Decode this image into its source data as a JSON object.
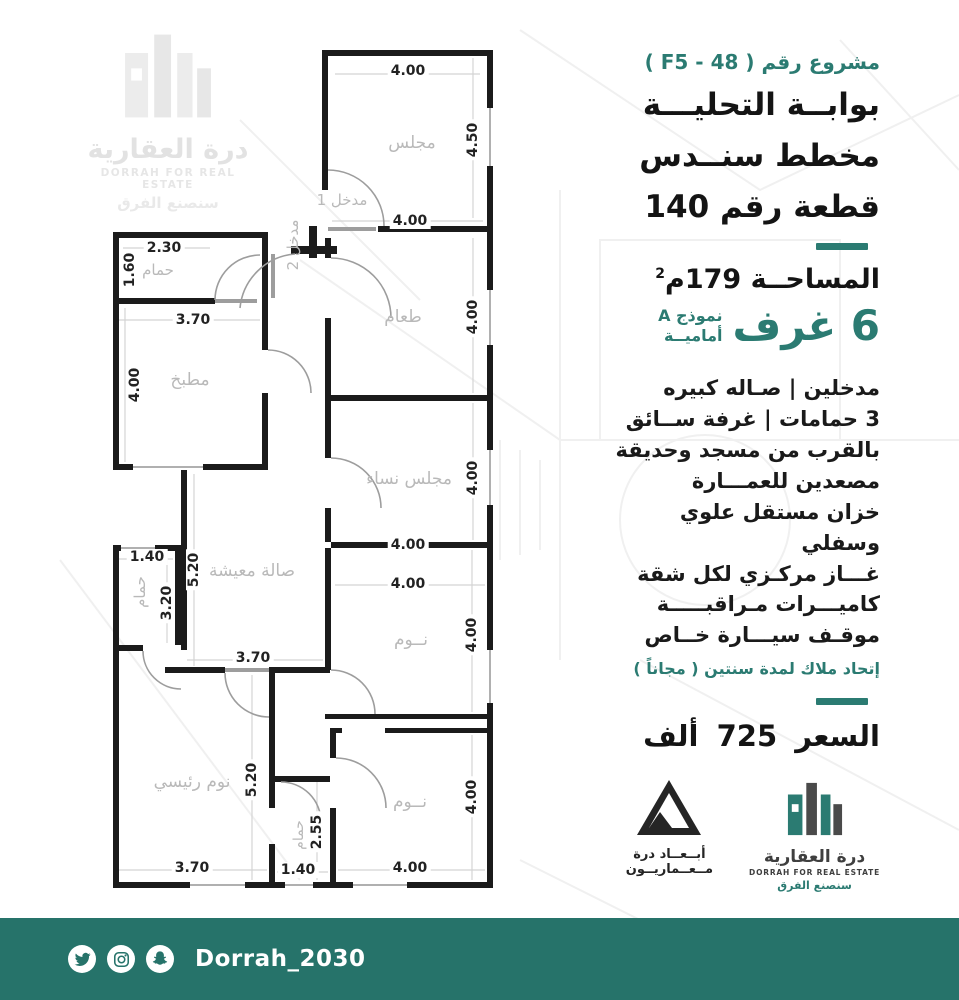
{
  "colors": {
    "accent": "#2b7b72",
    "footer": "#26736a"
  },
  "watermark": {
    "name_ar": "درة العقارية",
    "name_en": "DORRAH FOR REAL ESTATE",
    "tagline": "سنصنع الفرق"
  },
  "panel": {
    "project_label": "مشروع رقم ( F5 - 48 )",
    "title_lines": [
      "بوابــة التحليـــة",
      "مخطط سنــدس",
      "قطعة رقم 140"
    ],
    "area_label": "المساحــة 179م",
    "area_sup": "2",
    "rooms_big": "6 غرف",
    "model_line1": "نموذج A",
    "model_line2": "أماميــة",
    "features": [
      "مدخلين  |  صـاله كبيره",
      "3 حمامات | غرفة ســائق",
      "بالقرب من مسجد وحديقة",
      "مصعدين  للعمـــارة",
      "خزان مستقل علوي وسفلي",
      "غـــاز مركـزي لكل شقة",
      "كاميـــرات مـراقبـــــة",
      "موقـف سيـــارة خــاص"
    ],
    "hoa_note": "إتحاد ملاك لمدة سنتين ( مجاناً )",
    "price": "السعر 725 ألف"
  },
  "plan": {
    "room_labels": {
      "majlis": "مجلس",
      "dining": "طعام",
      "women_majlis": "مجلس نساء",
      "bedroom_1": "نــوم",
      "bedroom_2": "نــوم",
      "kitchen": "مطبخ",
      "bath_top": "حمام",
      "living": "صالة معيشة",
      "bath_left": "حمام",
      "master_bedroom": "نوم رئيسي",
      "bath_bottom": "حمام",
      "entrance_1": "مدخل 1",
      "entrance_2": "مدخل 2"
    },
    "dimensions": {
      "majlis_top": "4.00",
      "majlis_right": "4.50",
      "majlis_bottom": "4.00",
      "bath_top_width": "2.30",
      "bath_top_height": "1.60",
      "kitchen_width": "3.70",
      "kitchen_height": "4.00",
      "dining_right": "4.00",
      "women_right": "4.00",
      "women_bottom": "4.00",
      "bedroom1_top": "4.00",
      "bedroom1_right": "4.00",
      "living_height": "5.20",
      "living_width": "3.70",
      "bath_left_width": "1.40",
      "bath_left_height": "3.20",
      "master_height": "5.20",
      "master_width": "3.70",
      "bath_bottom_height": "2.55",
      "bath_bottom_width": "1.40",
      "bedroom2_right": "4.00",
      "bedroom2_bottom": "4.00"
    }
  },
  "logos": {
    "architect": {
      "line1": "أبــعــاد درة",
      "line2": "مــعــماريــون"
    },
    "dorrah": {
      "name_ar": "درة العقارية",
      "name_en": "DORRAH FOR REAL ESTATE",
      "tagline": "سنصنع الفرق"
    }
  },
  "footer": {
    "handle": "Dorrah_2030",
    "icons": [
      "twitter-icon",
      "instagram-icon",
      "snapchat-icon"
    ]
  }
}
